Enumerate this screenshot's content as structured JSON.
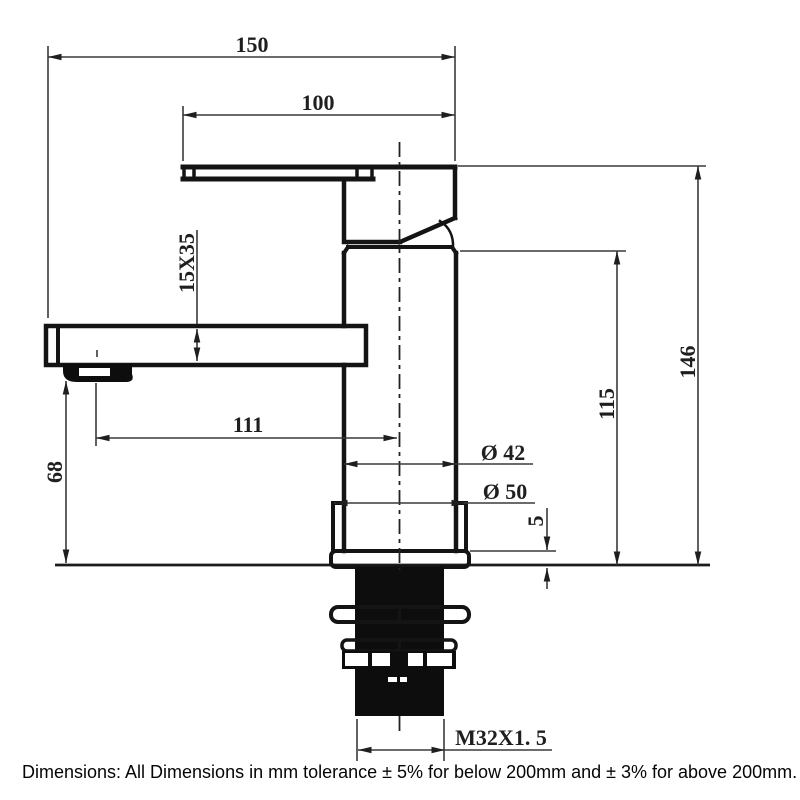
{
  "dimensions": {
    "overall_width": "150",
    "handle_length": "100",
    "spout_section": "15X35",
    "spout_reach": "111",
    "spout_clearance": "68",
    "overall_height": "146",
    "body_height": "115",
    "body_diameter": "Ø 42",
    "base_diameter": "Ø 50",
    "base_plate_thickness": "5",
    "thread_size": "M32X1. 5"
  },
  "note": "Dimensions: All Dimensions in mm tolerance ± 5% for below 200mm and ± 3% for above 200mm."
}
